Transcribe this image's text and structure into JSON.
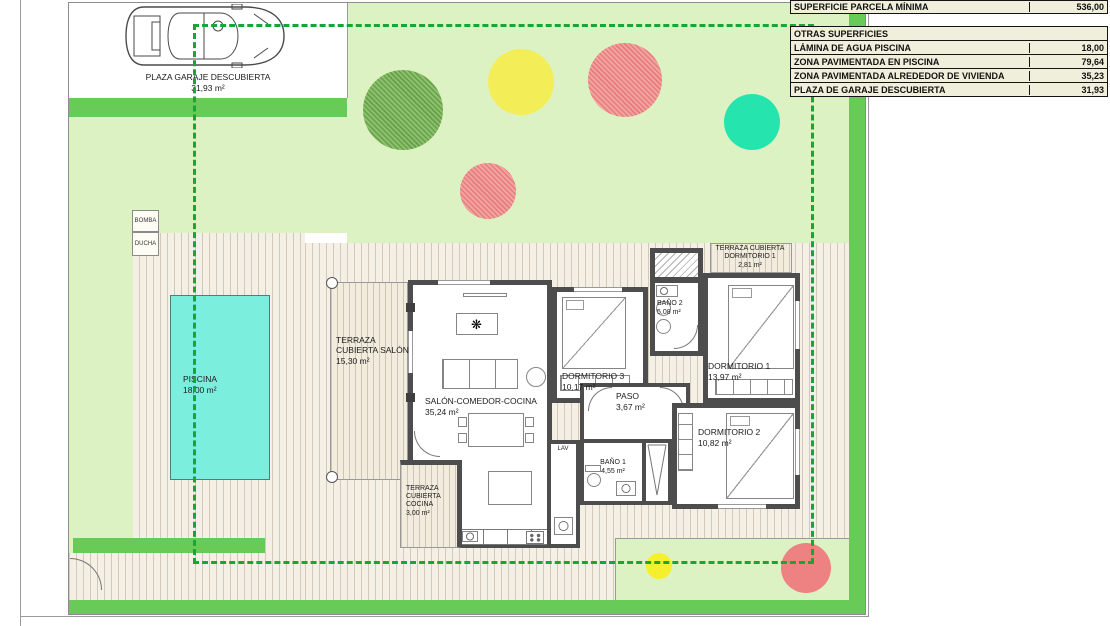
{
  "site": {
    "garage": {
      "label": "PLAZA GARAJE DESCUBIERTA",
      "area": "31,93 m²"
    },
    "pool": {
      "label": "PISCINA",
      "area": "18,00 m²"
    },
    "pump": {
      "label": "BOMBA"
    },
    "shower": {
      "label": "DUCHA"
    }
  },
  "rooms": {
    "terraza_salon": {
      "label": "TERRAZA CUBIERTA SALÓN",
      "area": "15,30 m²"
    },
    "salon": {
      "label": "SALÓN-COMEDOR-COCINA",
      "area": "35,24 m²"
    },
    "dorm3": {
      "label": "DORMITORIO 3",
      "area": "10,17 m²"
    },
    "bano2": {
      "label": "BAÑO 2",
      "area": "5,08 m²"
    },
    "dorm1": {
      "label": "DORMITORIO 1",
      "area": "13,97 m²"
    },
    "terraza_dorm1": {
      "label": "TERRAZA CUBIERTA DORMITORIO 1",
      "area": "2,81 m²"
    },
    "paso": {
      "label": "PASO",
      "area": "3,67 m²"
    },
    "bano1": {
      "label": "BAÑO 1",
      "area": "4,55 m²"
    },
    "dorm2": {
      "label": "DORMITORIO 2",
      "area": "10,82 m²"
    },
    "terraza_cocina": {
      "label": "TERRAZA CUBIERTA COCINA",
      "area": "3,00 m²"
    },
    "lav": {
      "label": "LAV"
    }
  },
  "tables": {
    "parcela": {
      "label": "SUPERFICIE PARCELA MÍNIMA",
      "value": "536,00"
    },
    "otras": {
      "header": {
        "label": "OTRAS SUPERFICIES",
        "value": ""
      },
      "rows": [
        {
          "label": "LÁMINA DE AGUA PISCINA",
          "value": "18,00"
        },
        {
          "label": "ZONA PAVIMENTADA EN PISCINA",
          "value": "79,64"
        },
        {
          "label": "ZONA PAVIMENTADA ALREDEDOR DE VIVIENDA",
          "value": "35,23"
        },
        {
          "label": "PLAZA DE GARAJE DESCUBIERTA",
          "value": "31,93"
        }
      ]
    }
  },
  "icons": {
    "plant": "❋"
  },
  "colors": {
    "lawn": "#ddf2c3",
    "hedge": "#68cb57",
    "pool": "#7ceede",
    "parcel_dashed": "#17a634",
    "wall": "#4d4d4d",
    "paving_bg": "#f5f0e6",
    "paving_line": "#d2c9b8",
    "tree_yellow": "#f3ee58",
    "tree_teal": "#25e4ad",
    "tree_salmon": "#ee8282",
    "table_bg": "#f0efdb"
  }
}
